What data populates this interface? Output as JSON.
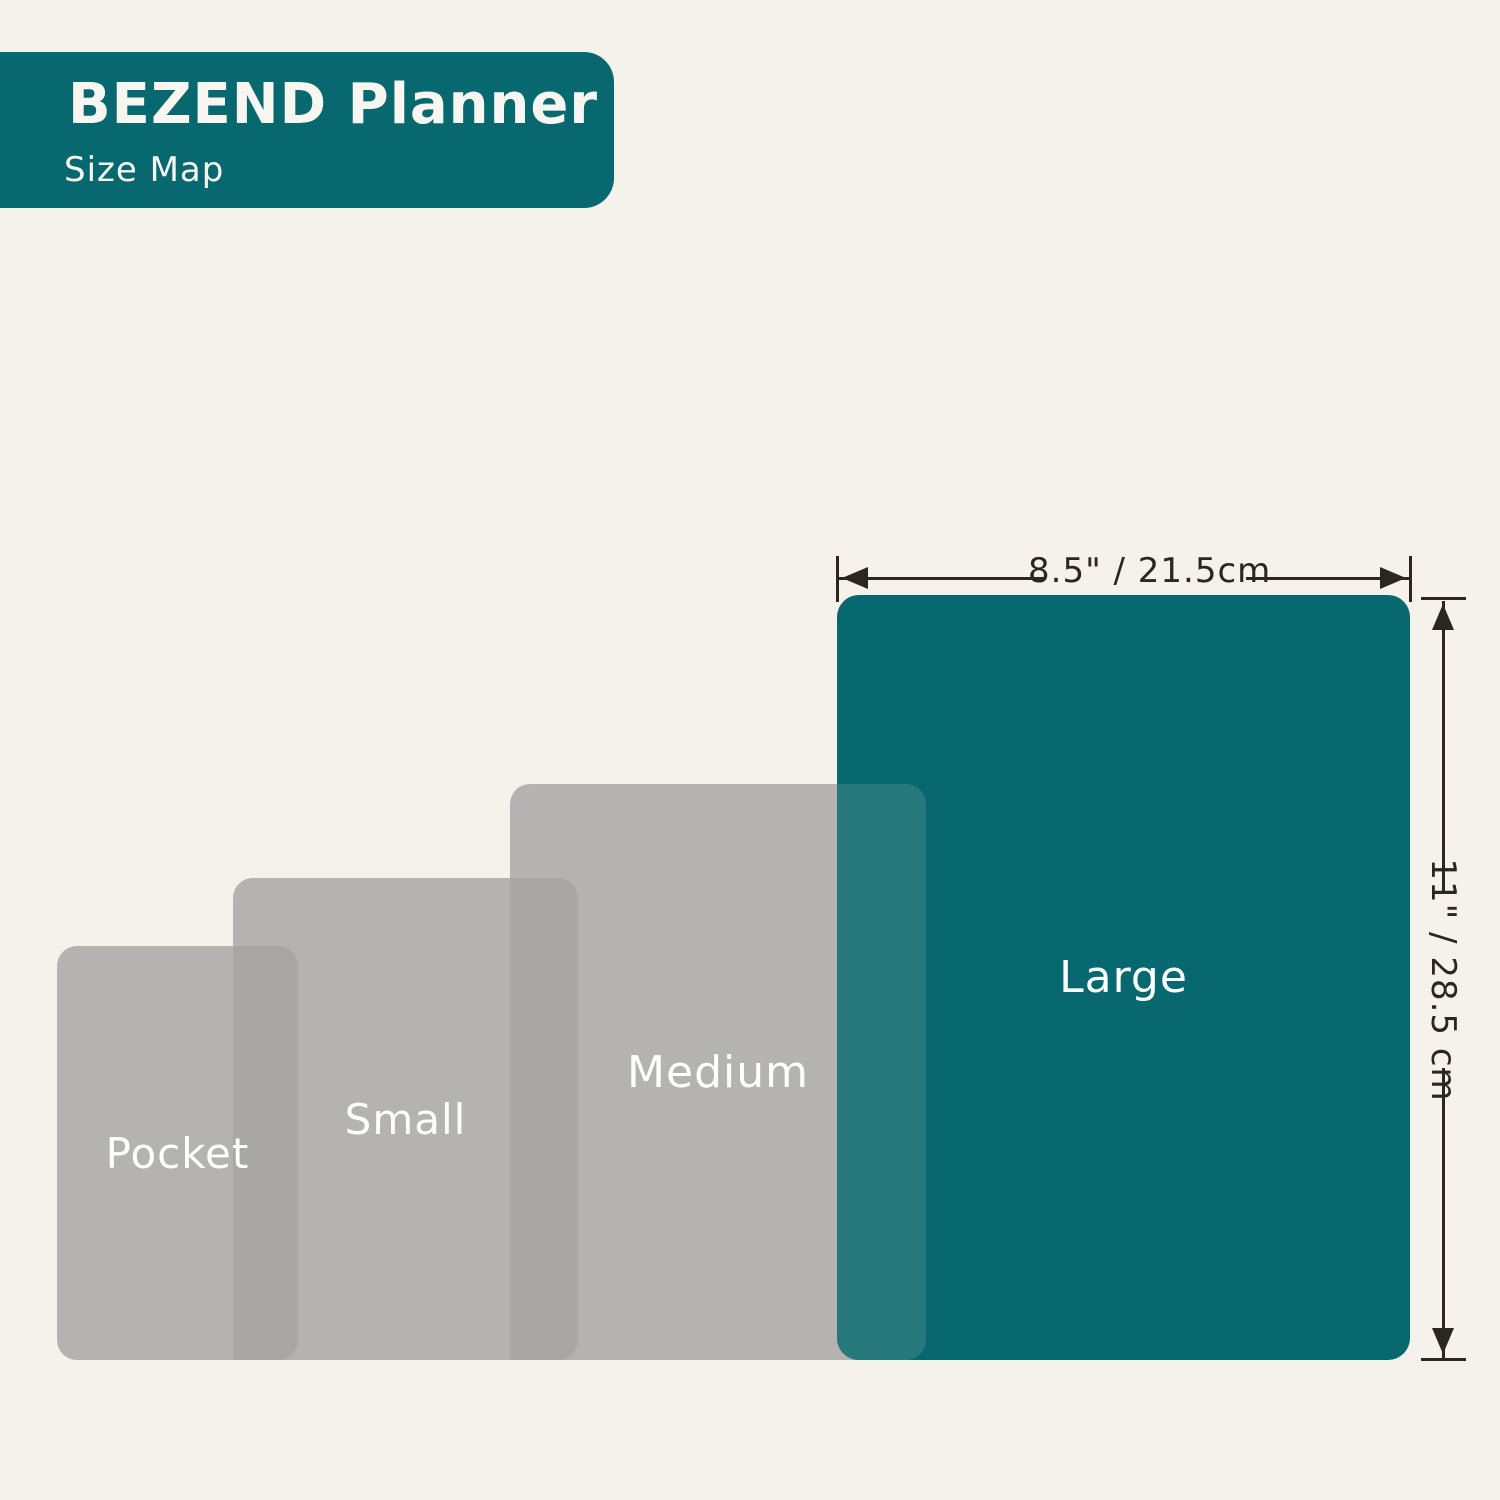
{
  "header": {
    "title": "BEZEND Planner",
    "subtitle": "Size Map"
  },
  "sizes": [
    {
      "id": "pocket",
      "label": "Pocket"
    },
    {
      "id": "small",
      "label": "Small"
    },
    {
      "id": "medium",
      "label": "Medium"
    },
    {
      "id": "large",
      "label": "Large",
      "width_label": "8.5\" / 21.5cm",
      "height_label": "11\" / 28.5 cm"
    }
  ],
  "dimensions": {
    "width_label": "8.5\" / 21.5cm",
    "height_label": "11\" / 28.5 cm"
  },
  "colors": {
    "background": "#F5F2EB",
    "teal": "#07696F",
    "teal_overlap": "#26787A",
    "gray": "#B5B3B1",
    "gray_overlap": "#A9A7A5",
    "line": "#2B2620",
    "label_text": "#FFFFFF",
    "header_text": "#F7F6F1"
  }
}
